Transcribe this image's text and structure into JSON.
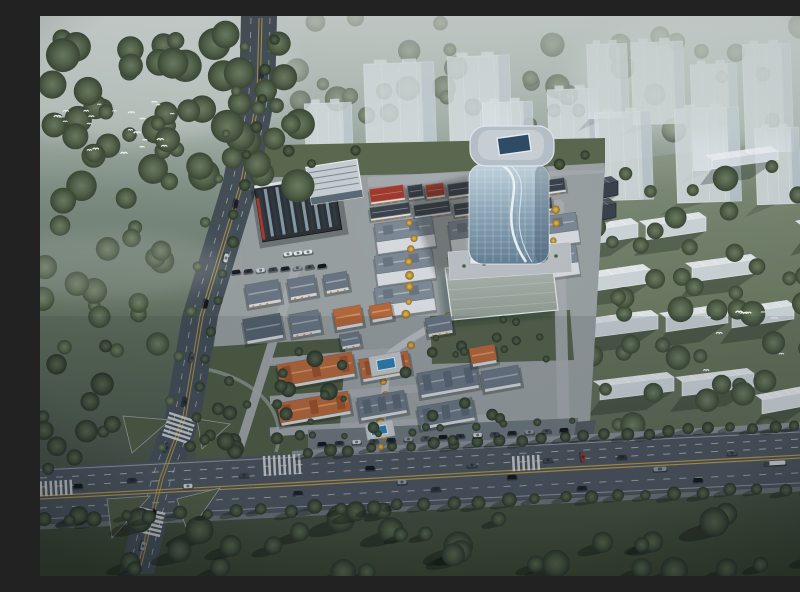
{
  "meta": {
    "title": "Aerial architectural rendering - mixed-use development masterplan at dusk in fog",
    "render_style": "photorealistic CG bird's-eye view",
    "canvas": "800x560"
  },
  "scene": {
    "setting": "planned mixed-use quarter surrounded by fog-covered woodland, viewed from high above at dusk",
    "landmarks": {
      "glass_tower": "curved blue glass high-rise with rounded white roof deck and dark skylight",
      "office_block": "dark low-rise office building with ribbed glass roof and red accent edge",
      "annex": "white-roofed annex attached to the office block",
      "retail_strip": "row of small shop blocks, several with red roofs and orange awnings",
      "townhouse_grid": "grid of slate-roofed townhouse clusters with golden street trees",
      "village_quarter": "European-style low-rise buildings with orange tile and slate mansard roofs",
      "pools": "two small turquoise pools with pale decks on the central axis",
      "plaza": "light paved forecourt with kiosks at the tower base",
      "flat_building": "large flat-roofed hall south-east of the plaza",
      "ghost_towers": "translucent white massing towers to the north",
      "ghost_slabs": "rows of translucent low residential slabs to the east",
      "boulevard": "tree-lined multi-lane road across the bottom with yellow median lines",
      "avenue": "avenue running down the left side",
      "intersection": "X-shaped crossing with triangular grass islands and zebra crossings",
      "forest": "dense misty tree canopy at top-left and foreground grass with long shadows",
      "birds": "two flocks of small white birds"
    },
    "counts": {
      "ghost_towers": 13,
      "ghost_slabs": 14,
      "townhouse_clusters": 7,
      "retail_units": 13,
      "village_buildings": 17,
      "pools": 2,
      "birds": 37
    },
    "vehicles": {
      "boulevard_cars": 19,
      "boulevard_note": "includes one white box truck and one long bus",
      "avenue_cars": 10,
      "parked_cars": 26,
      "red_service_car": 1
    }
  },
  "palette": {
    "fog": "#c3cdc9",
    "canopy": "#4f5f4c",
    "canopy_dark": "#303b2d",
    "grass": "#5a684e",
    "grass_dark": "#3a4430",
    "road": "#454f58",
    "lane_yellow": "#bd9d49",
    "lane_white": "#d2d6d8",
    "ghost": "#e2eaf0",
    "glass_blue": "#8aa4b6",
    "roof_orange": "#b5683c",
    "roof_slate": "#6a7684",
    "roof_red": "#9e3b31",
    "wall": "#d8dcdf",
    "plaza": "#b8bec3",
    "pool": "#2e7fae",
    "gold_tree": "#c9a24b",
    "awning": "#cf7f3a",
    "accent_red": "#a83a2e"
  }
}
